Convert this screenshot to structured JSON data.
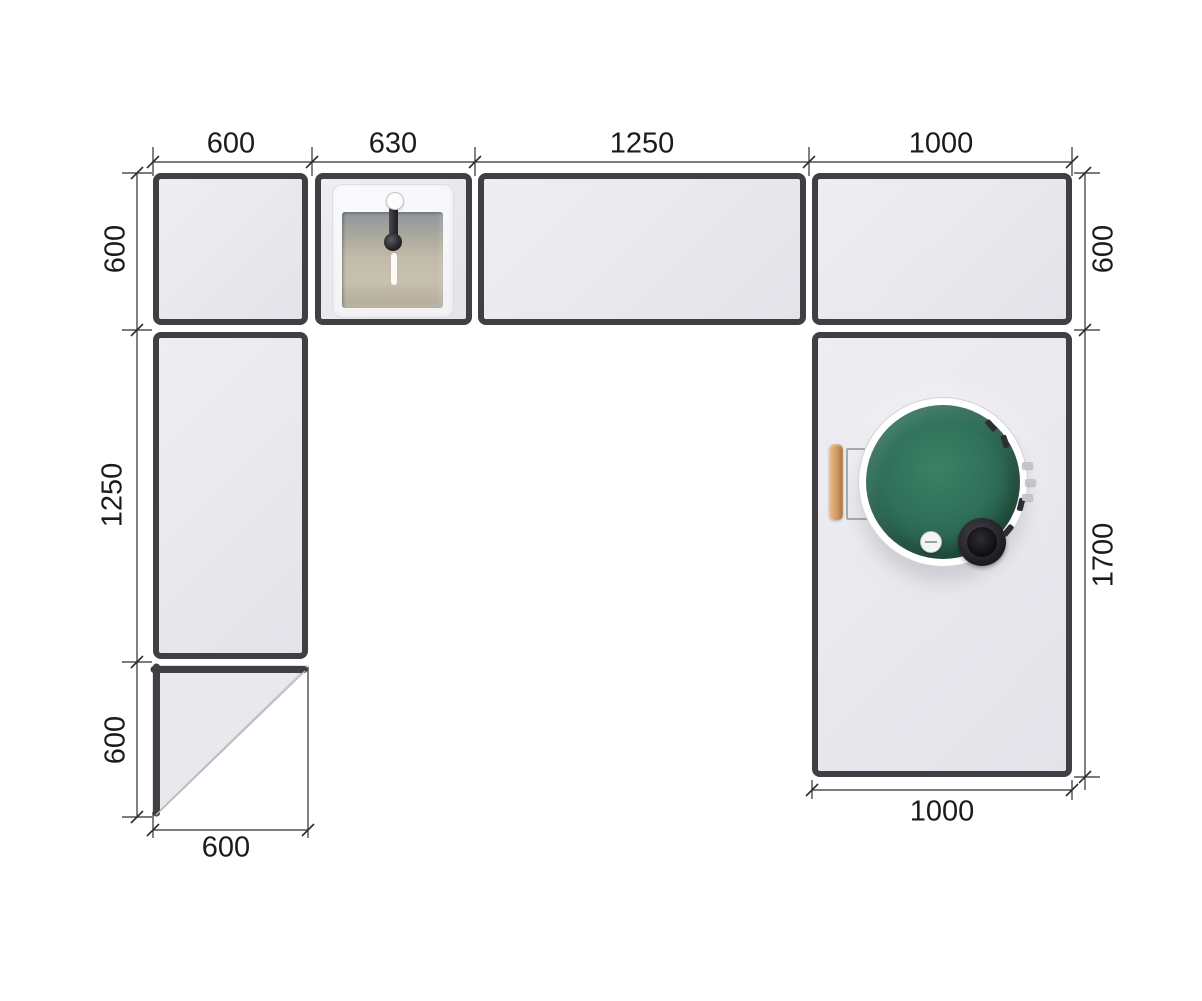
{
  "drawing": {
    "kind": "kitchen-counter-plan-top-view",
    "colors": {
      "background": "#ffffff",
      "module_border": "#3f3f44",
      "module_fill": "#e9e8ed",
      "dimension_line": "#2f2f2f",
      "label_text": "#1b1b1b",
      "grill_green": "#2e6f58",
      "grill_vent_black": "#1b1b1f",
      "handle_wood": "#cf9a63",
      "sink_basin": "#c2bbaa"
    },
    "dimensions": {
      "top": [
        {
          "label": "600"
        },
        {
          "label": "630"
        },
        {
          "label": "1250"
        },
        {
          "label": "1000"
        }
      ],
      "left": [
        {
          "label": "600"
        },
        {
          "label": "1250"
        },
        {
          "label": "600"
        }
      ],
      "right": [
        {
          "label": "600"
        },
        {
          "label": "1700"
        }
      ],
      "bottom_left": {
        "label": "600"
      },
      "bottom_right": {
        "label": "1000"
      }
    }
  }
}
